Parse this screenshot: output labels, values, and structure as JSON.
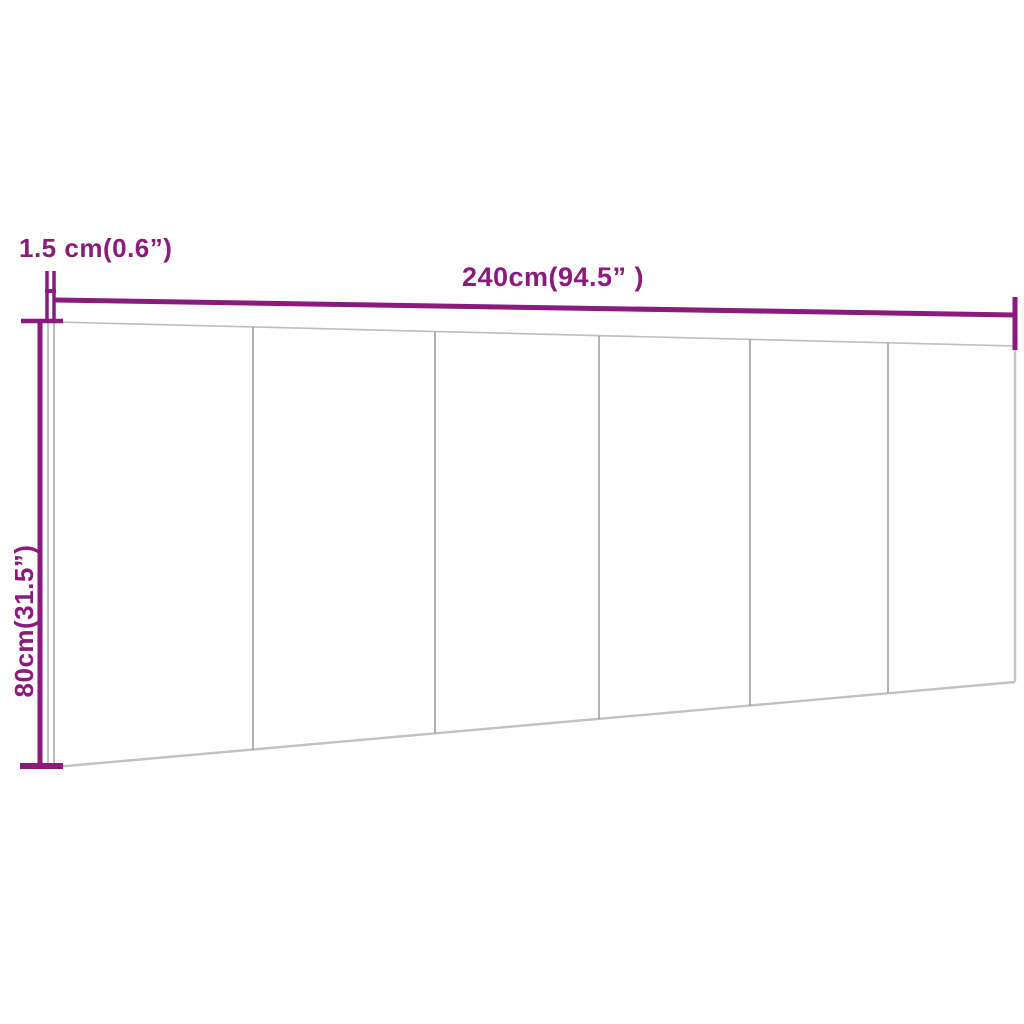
{
  "page": {
    "background": "#ffffff"
  },
  "diagram": {
    "subject": "headboard-panel-dimension-diagram",
    "section_count": 6,
    "style": {
      "dimension_color": "#8a1a7c",
      "panel_edge_color": "#bfbfbf",
      "seam_color": "#9a9a9a"
    },
    "labels": {
      "thickness": "1.5 cm(0.6”)",
      "width": "240cm(94.5” )",
      "height": "80cm(31.5”)"
    },
    "values": {
      "thickness_cm": 1.5,
      "thickness_in": 0.6,
      "width_cm": 240,
      "width_in": 94.5,
      "height_cm": 80,
      "height_in": 31.5
    }
  }
}
